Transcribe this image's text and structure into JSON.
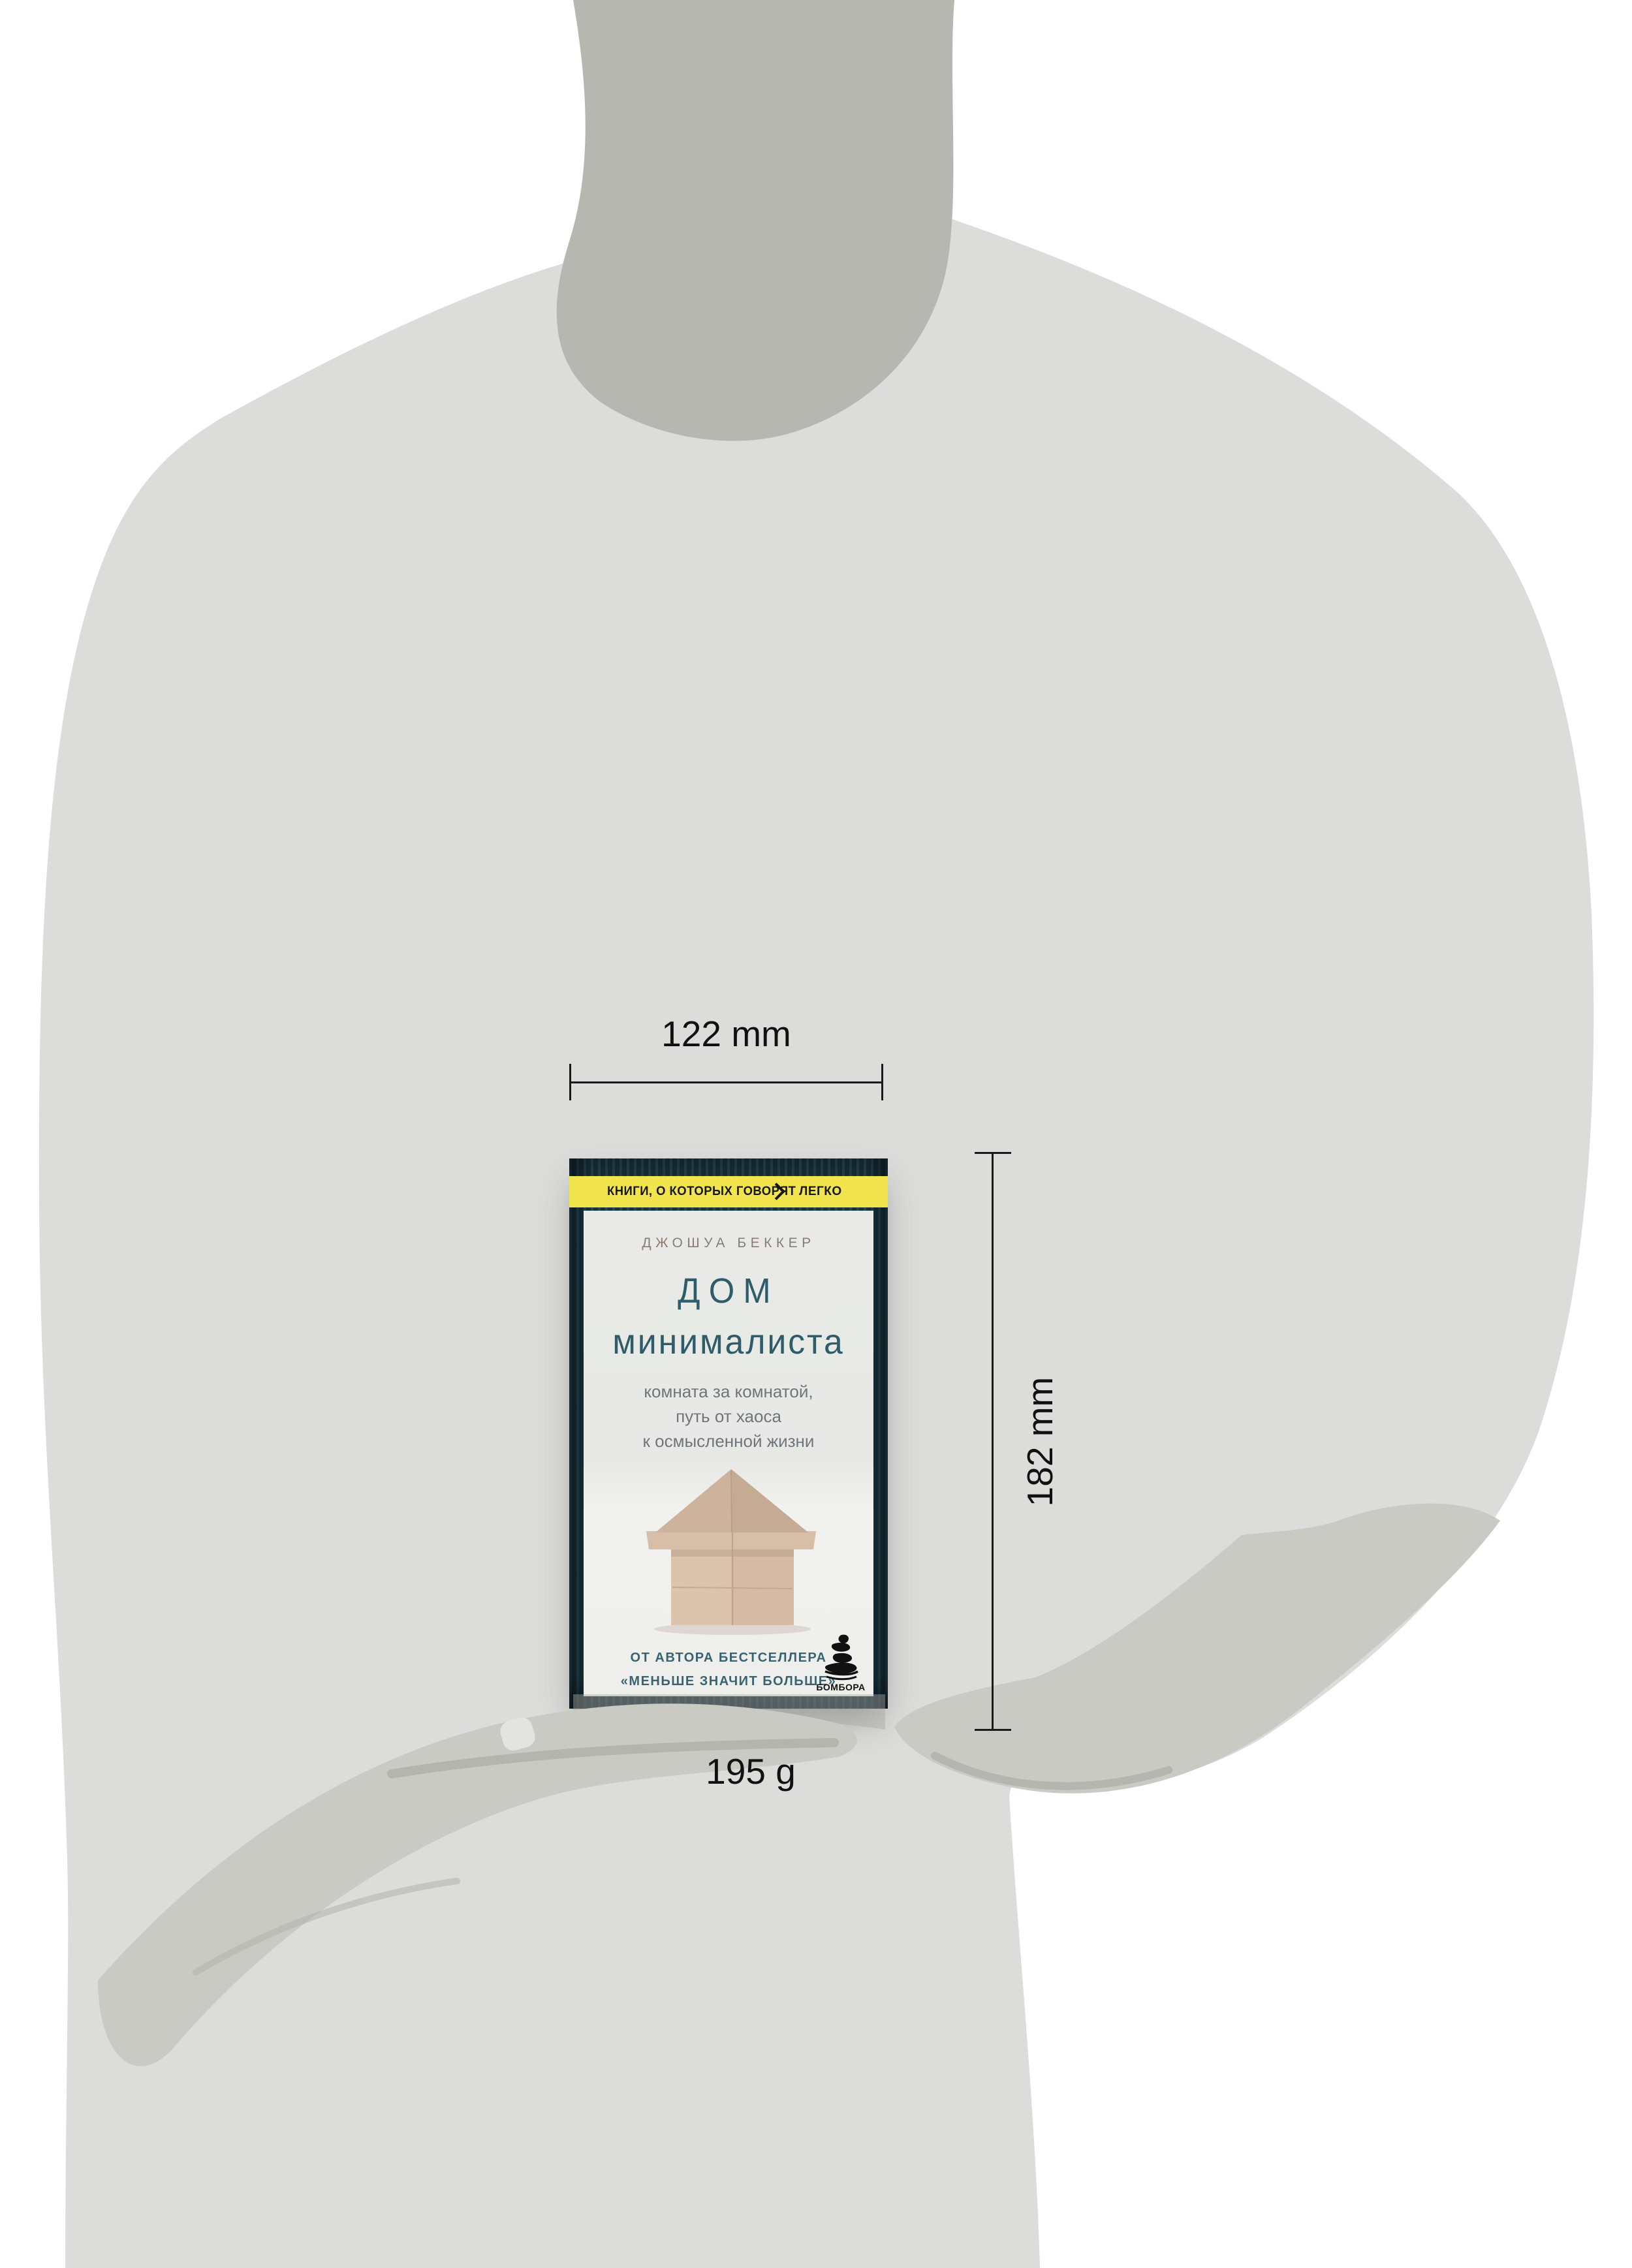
{
  "annotations": {
    "width_label": "122 mm",
    "height_label": "182 mm",
    "weight_label": "195 g"
  },
  "book": {
    "banner": {
      "left_text": "КНИГИ, О КОТОРЫХ ГОВОРЯТ",
      "right_text": "ЛЕГКО",
      "chevron_icon": "chevron-right",
      "bg_color": "#f2e44c"
    },
    "author": "ДЖОШУА БЕККЕР",
    "title_line1": "ДОМ",
    "title_line2": "минималиста",
    "subtitle_lines": [
      "комната за комнатой,",
      "путь от хаоса",
      "к осмысленной жизни"
    ],
    "footer_line1": "ОТ АВТОРА БЕСТСЕЛЛЕРА",
    "footer_line2": "«МЕНЬШЕ ЗНАЧИТ БОЛЬШЕ»",
    "publisher": "БОМБОРА",
    "illustration": "wooden-block-house",
    "colors": {
      "accent_yellow": "#f2e44c",
      "cover_wood": "#1d3a46",
      "title_teal": "#2f5c6a",
      "footer_teal": "#3a6372",
      "author_brown": "#8b7c72",
      "wood_blocks": "#d9c0aa"
    }
  },
  "figure": {
    "description": "gray-mannequin-silhouette-holding-book",
    "body_color": "#dcdcdb",
    "neck_color": "#b6b7b1",
    "hands_color": "#c9cac4"
  }
}
